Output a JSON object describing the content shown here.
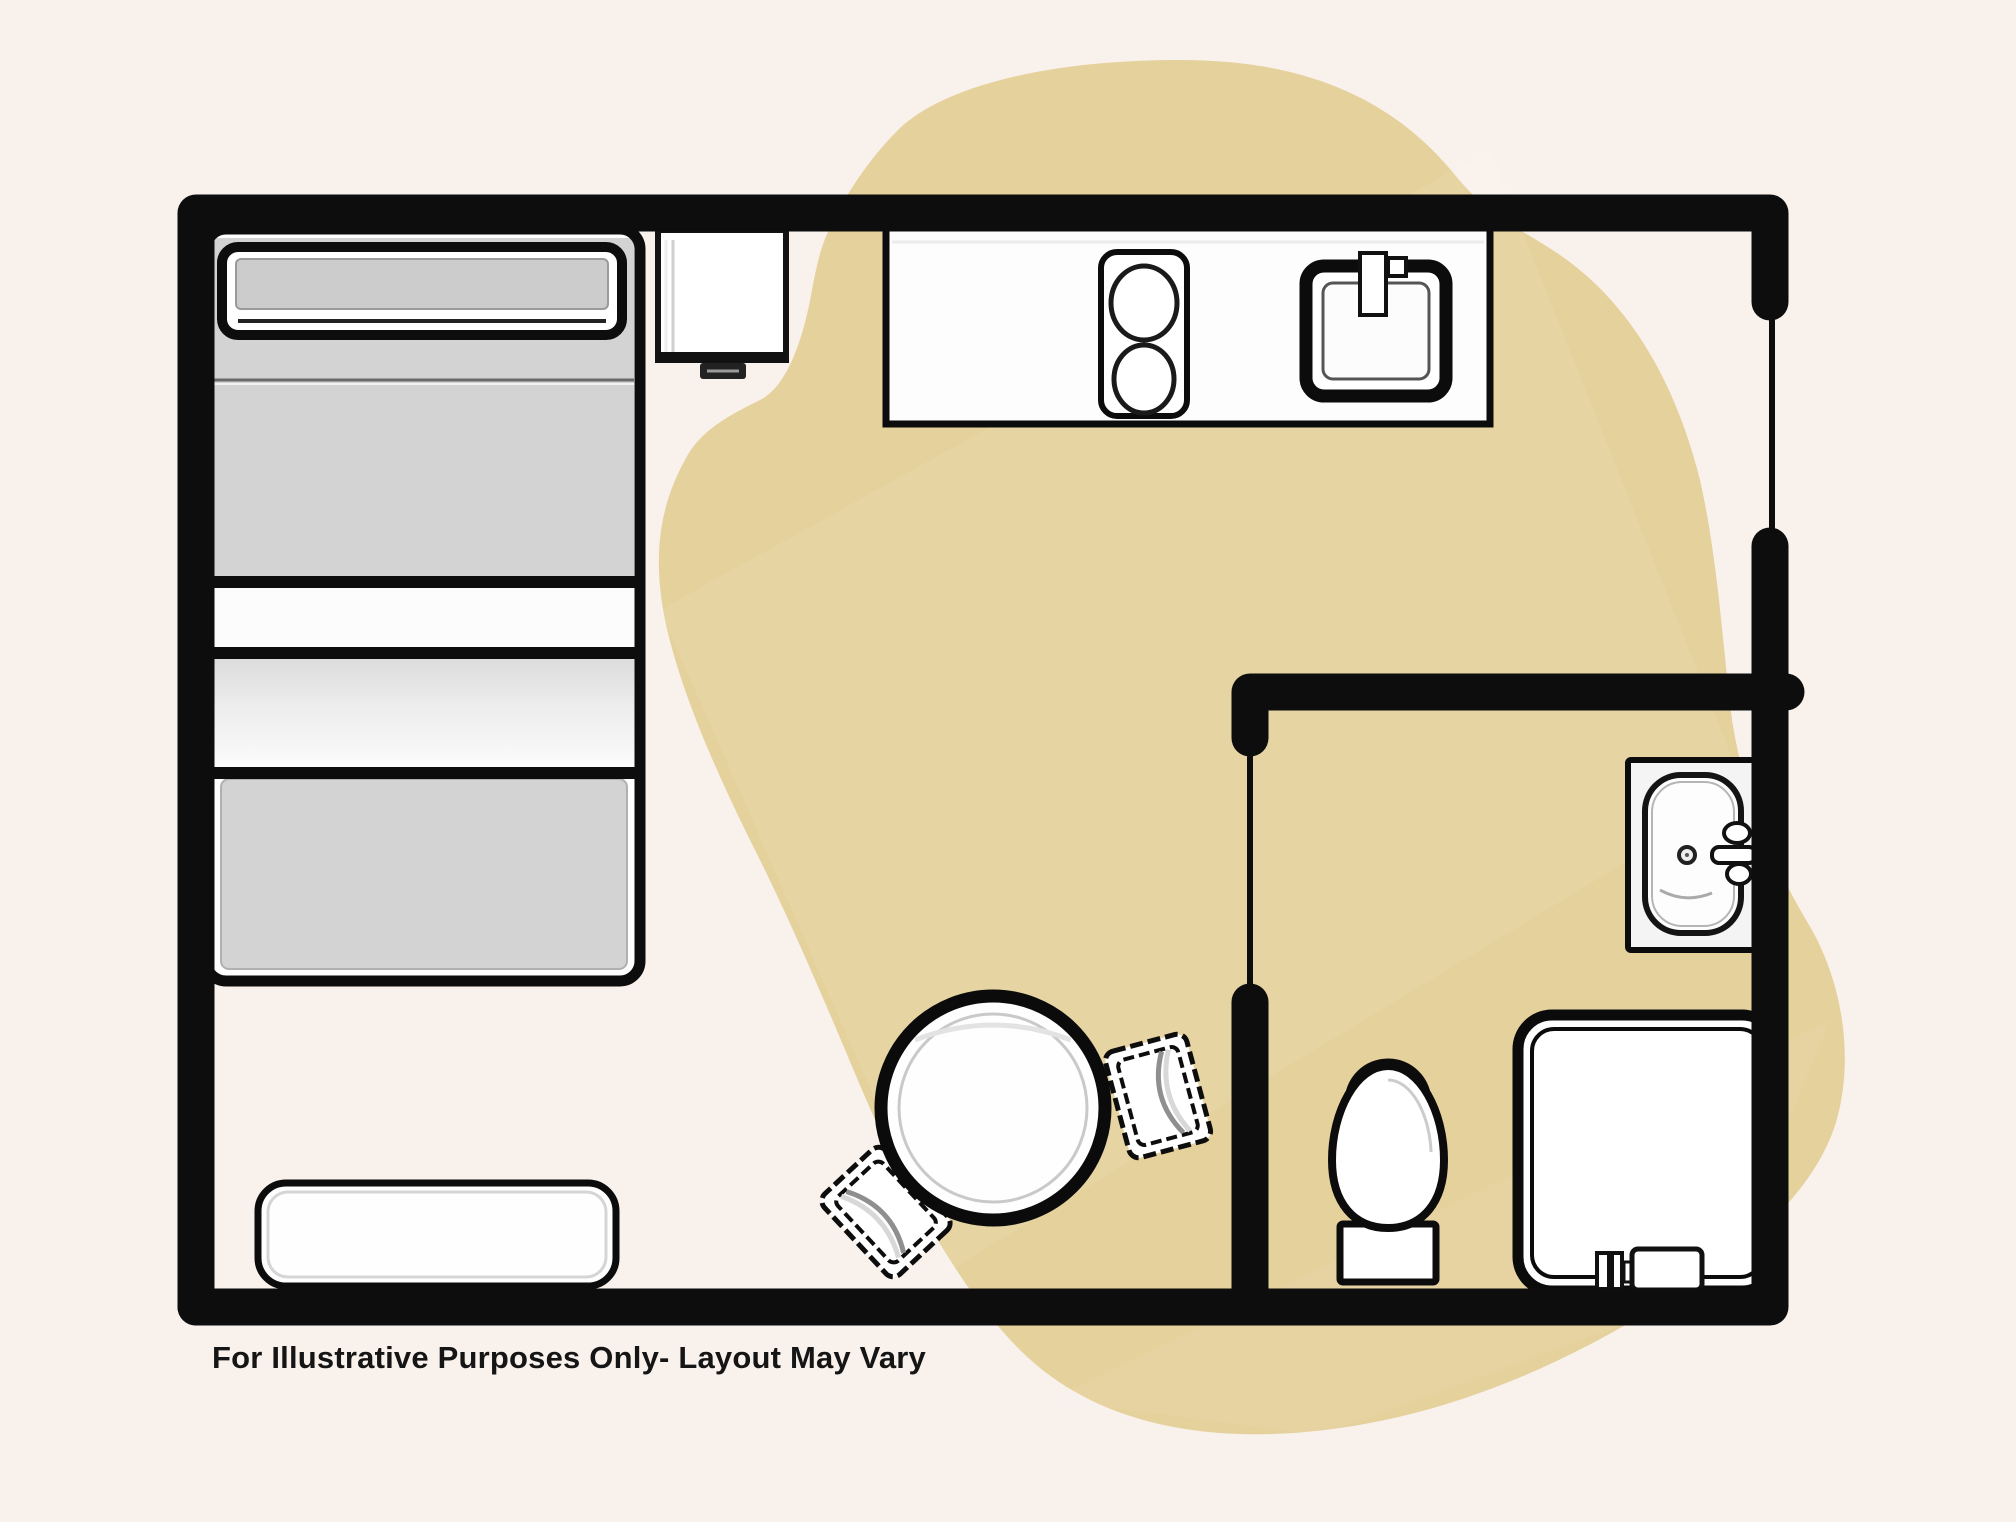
{
  "title": "Studio apartment floor plan",
  "caption": {
    "text": "For Illustrative Purposes Only- Layout May Vary"
  },
  "colors": {
    "background": "#f9f1ec",
    "blob": "#e5d19c",
    "blob_highlight": "#ffffff",
    "wall": "#0d0d0d",
    "furniture_fill": "#ffffff",
    "bed_gray": "#d3d3d3",
    "caption": "#151515"
  },
  "floorplan": {
    "rooms": [
      {
        "id": "main-room",
        "label": "Main living area with kitchen and sleeping area"
      },
      {
        "id": "bathroom",
        "label": "Bathroom with sink, toilet and shower"
      }
    ],
    "furniture": [
      {
        "id": "bed",
        "label": "Bed with pillow and blanket"
      },
      {
        "id": "nightstand",
        "label": "Nightstand"
      },
      {
        "id": "kitchen-counter",
        "label": "Kitchen counter"
      },
      {
        "id": "stove",
        "label": "Two-burner stove"
      },
      {
        "id": "kitchen-sink",
        "label": "Kitchen sink with faucet"
      },
      {
        "id": "dining-table",
        "label": "Round dining table"
      },
      {
        "id": "chair-right",
        "label": "Dining chair"
      },
      {
        "id": "chair-left",
        "label": "Dining chair"
      },
      {
        "id": "bench",
        "label": "Bench"
      },
      {
        "id": "bathroom-sink",
        "label": "Bathroom sink with faucet"
      },
      {
        "id": "toilet",
        "label": "Toilet"
      },
      {
        "id": "shower",
        "label": "Shower stall"
      }
    ],
    "openings": [
      {
        "id": "right-wall-opening",
        "label": "Opening in right wall"
      },
      {
        "id": "bathroom-door-opening",
        "label": "Bathroom door opening"
      }
    ]
  }
}
